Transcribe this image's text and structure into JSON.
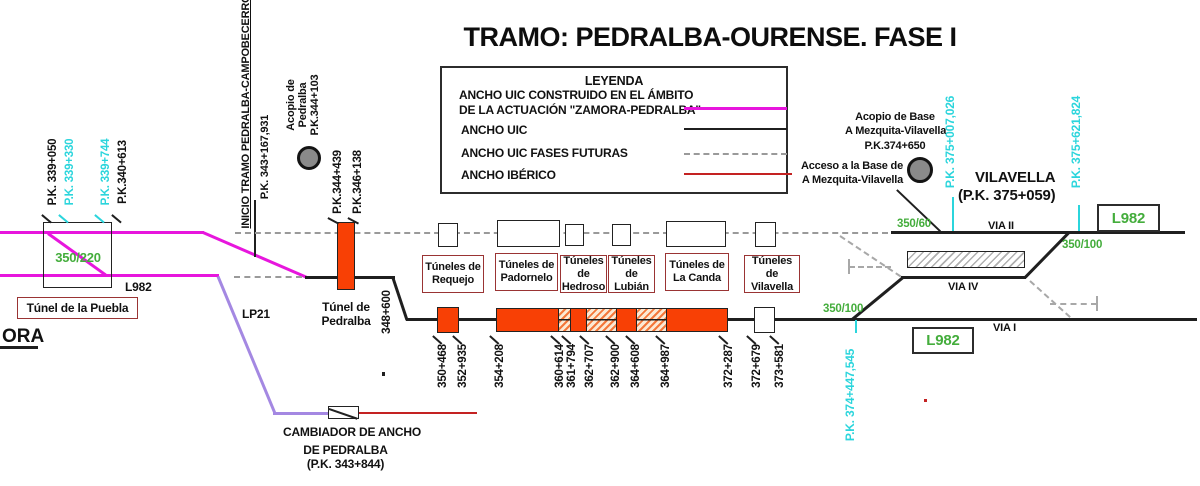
{
  "title": "TRAMO: PEDRALBA-OURENSE. FASE I",
  "legend": {
    "title": "LEYENDA",
    "item1_line1": "ANCHO UIC CONSTRUIDO EN EL ÁMBITO",
    "item1_line2": "DE LA ACTUACIÓN \"ZAMORA-PEDRALBA\"",
    "item2": "ANCHO UIC",
    "item3": "ANCHO UIC FASES FUTURAS",
    "item4": "ANCHO IBÉRICO"
  },
  "colors": {
    "uic_zamora_pedralba": "#e716dd",
    "uic": "#1f1f1f",
    "uic_future": "#9a9a9a",
    "iberico": "#c42222",
    "tunnel_fill": "#f84005",
    "cyan_pk": "#2bd5dc",
    "green_speed": "#44ad3c",
    "purple_line": "#a488e2"
  },
  "left_pks": [
    {
      "text": "P.K. 339+050"
    },
    {
      "text": "P.K. 339+330"
    },
    {
      "text": "P.K. 339+744"
    },
    {
      "text": "P.K.340+613"
    }
  ],
  "left": {
    "speed": "350/220",
    "line_code": "L982",
    "tunnel_name": "Túnel de la Puebla",
    "edge_text": "ORA",
    "lp_code": "LP21"
  },
  "inicio": {
    "line1": "INICIO TRAMO PEDRALBA-CAMPOBECERROS",
    "line2": "P.K. 343+167,931"
  },
  "acopio_pedralba": {
    "line1": "Acopio de",
    "line2": "Pedralba",
    "line3": "P.K.344+103"
  },
  "pedralba": {
    "pk_in": "P.K.344+439",
    "pk_out": "P.K.346+138",
    "name_line1": "Túnel de",
    "name_line2": "Pedralba",
    "pk_bend": "348+600"
  },
  "cambiador": {
    "line1": "CAMBIADOR DE ANCHO",
    "line2": "DE PEDRALBA",
    "line3": "(P.K. 343+844)"
  },
  "tunnel_groups": [
    {
      "line1": "Túneles de",
      "line2": "Requejo"
    },
    {
      "line1": "Túneles de",
      "line2": "Padornelo"
    },
    {
      "line1": "Túneles de",
      "line2": "Hedroso"
    },
    {
      "line1": "Túneles de",
      "line2": "Lubián"
    },
    {
      "line1": "Túneles de",
      "line2": "La Canda"
    },
    {
      "line1": "Túneles de",
      "line2": "Vilavella"
    }
  ],
  "pk_ticks": [
    {
      "text": "350+468"
    },
    {
      "text": "352+935"
    },
    {
      "text": "354+208"
    },
    {
      "text": "360+614"
    },
    {
      "text": "361+794"
    },
    {
      "text": "362+707"
    },
    {
      "text": "362+900"
    },
    {
      "text": "364+608"
    },
    {
      "text": "364+987"
    },
    {
      "text": "372+287"
    },
    {
      "text": "372+679"
    },
    {
      "text": "373+581"
    }
  ],
  "station": {
    "acopio_line1": "Acopio de Base",
    "acopio_line2": "A Mezquita-Vilavella",
    "acopio_line3": "P.K.374+650",
    "acceso_line1": "Acceso a la Base de",
    "acceso_line2": "A Mezquita-Vilavella",
    "name": "VILAVELLA",
    "name_pk": "(P.K. 375+059)",
    "pk_entry": "P.K. 375+007,026",
    "pk_exit": "P.K. 375+621,824",
    "pk_south": "P.K. 374+447,545",
    "speed_entry": "350/60",
    "speed_left": "350/100",
    "speed_right": "350/100",
    "via2": "VIA II",
    "via4": "VIA IV",
    "via1": "VIA I",
    "l982_top": "L982",
    "l982_bottom": "L982"
  }
}
